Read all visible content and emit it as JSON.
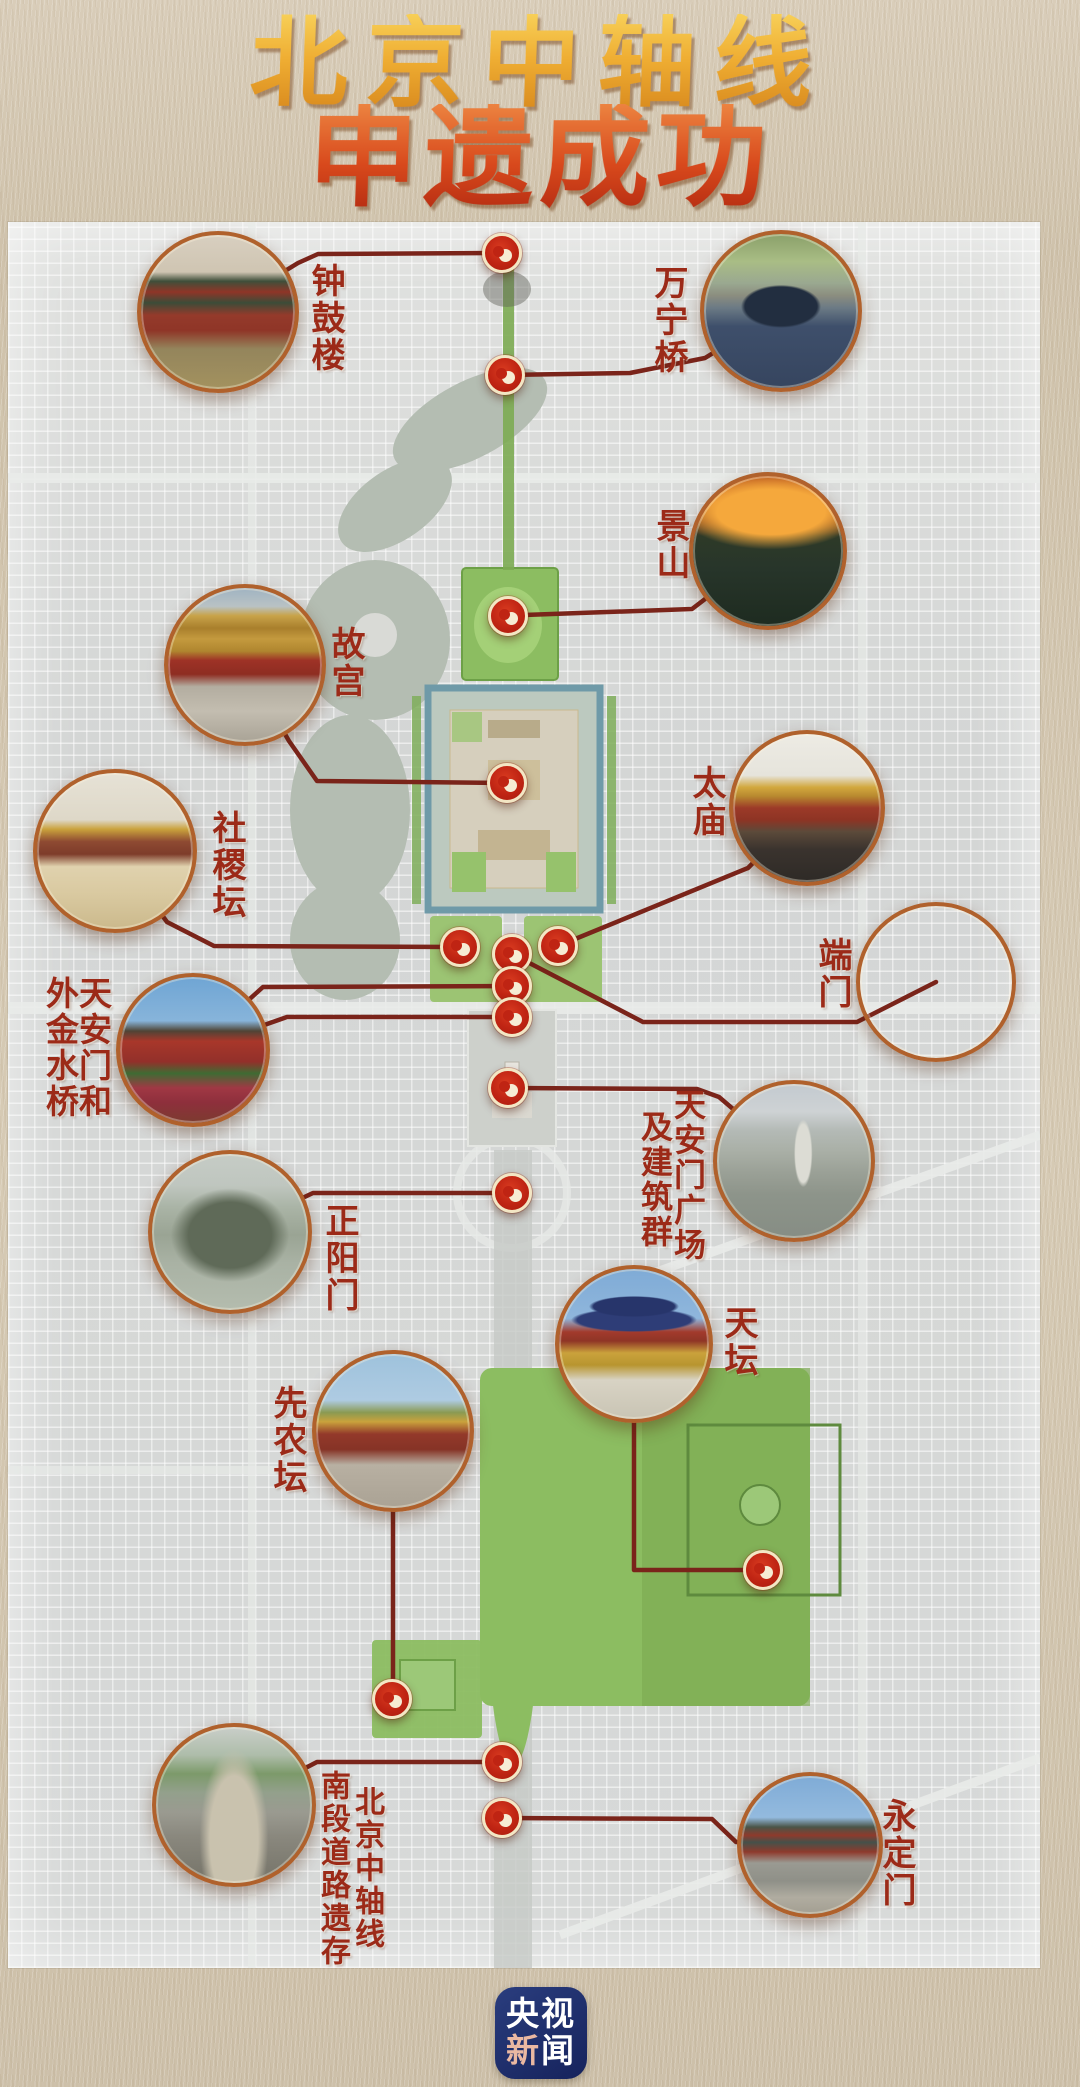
{
  "title": {
    "line1": "北京中轴线",
    "line2": "申遗成功"
  },
  "logo": {
    "c1": "央",
    "c2": "视",
    "c3": "新",
    "c4": "闻"
  },
  "colors": {
    "paper": "#d2c5ae",
    "map_base": "#d6d8d7",
    "park_green": "#8cbd61",
    "water_gray_green": "#b4bdb2",
    "moat_teal": "#6f9aa8",
    "connector_red": "#7a241a",
    "marker_red": "#bf2413",
    "marker_ring_cream": "#f3e6c4",
    "label_dark_red": "#9c2a18",
    "title_gold": "#efae33",
    "title_red_orange": "#d8491c",
    "logo_navy": "#1c2a66"
  },
  "landmarks": [
    {
      "id": "zhonggulou",
      "name": "钟鼓楼",
      "label_cols": [
        {
          "text": "钟鼓楼",
          "x": 327,
          "y": 263,
          "size": 34
        }
      ],
      "circle": {
        "x": 218,
        "y": 312,
        "r": 81
      },
      "markers": [
        [
          502,
          253
        ]
      ],
      "lines": [
        [
          [
            218,
            312
          ],
          [
            298,
            263
          ],
          [
            318,
            254
          ],
          [
            502,
            253
          ]
        ]
      ]
    },
    {
      "id": "wanningqiao",
      "name": "万宁桥",
      "label_cols": [
        {
          "text": "万宁桥",
          "x": 670,
          "y": 265,
          "size": 34
        }
      ],
      "circle": {
        "x": 781,
        "y": 311,
        "r": 81
      },
      "markers": [
        [
          505,
          375
        ]
      ],
      "lines": [
        [
          [
            781,
            311
          ],
          [
            705,
            358
          ],
          [
            630,
            373
          ],
          [
            505,
            375
          ]
        ]
      ]
    },
    {
      "id": "jingshan",
      "name": "景山",
      "label_cols": [
        {
          "text": "景山",
          "x": 672,
          "y": 508,
          "size": 34
        }
      ],
      "circle": {
        "x": 768,
        "y": 551,
        "r": 79
      },
      "markers": [
        [
          508,
          616
        ]
      ],
      "lines": [
        [
          [
            768,
            551
          ],
          [
            692,
            609
          ],
          [
            524,
            615
          ],
          [
            508,
            616
          ]
        ]
      ]
    },
    {
      "id": "gugong",
      "name": "故宫",
      "label_cols": [
        {
          "text": "故宫",
          "x": 347,
          "y": 626,
          "size": 34
        }
      ],
      "circle": {
        "x": 245,
        "y": 665,
        "r": 81
      },
      "markers": [
        [
          507,
          783
        ]
      ],
      "lines": [
        [
          [
            245,
            665
          ],
          [
            289,
            741
          ],
          [
            317,
            781
          ],
          [
            507,
            783
          ]
        ]
      ]
    },
    {
      "id": "shejitan",
      "name": "社稷坛",
      "label_cols": [
        {
          "text": "社稷坛",
          "x": 228,
          "y": 810,
          "size": 34
        }
      ],
      "circle": {
        "x": 115,
        "y": 851,
        "r": 82
      },
      "markers": [
        [
          460,
          947
        ]
      ],
      "lines": [
        [
          [
            115,
            851
          ],
          [
            167,
            922
          ],
          [
            214,
            946
          ],
          [
            460,
            947
          ]
        ]
      ]
    },
    {
      "id": "taimiao",
      "name": "太庙",
      "label_cols": [
        {
          "text": "太庙",
          "x": 708,
          "y": 765,
          "size": 34
        }
      ],
      "circle": {
        "x": 807,
        "y": 808,
        "r": 78
      },
      "markers": [
        [
          558,
          946
        ]
      ],
      "lines": [
        [
          [
            807,
            808
          ],
          [
            748,
            868
          ],
          [
            558,
            946
          ]
        ]
      ]
    },
    {
      "id": "duanmen",
      "name": "端门",
      "label_cols": [
        {
          "text": "端门",
          "x": 834,
          "y": 937,
          "size": 34
        }
      ],
      "circle": {
        "x": 936,
        "y": 982,
        "r": 80
      },
      "markers": [
        [
          512,
          954
        ]
      ],
      "lines": [
        [
          [
            936,
            982
          ],
          [
            857,
            1022
          ],
          [
            643,
            1022
          ],
          [
            512,
            954
          ]
        ]
      ]
    },
    {
      "id": "tiananmen",
      "name": "天安门和外金水桥",
      "label_cols": [
        {
          "text": "天安门和",
          "x": 95,
          "y": 976,
          "size": 33
        },
        {
          "text": "外金水桥",
          "x": 62,
          "y": 976,
          "size": 33
        }
      ],
      "circle": {
        "x": 193,
        "y": 1050,
        "r": 77
      },
      "markers": [
        [
          512,
          986
        ],
        [
          512,
          1017
        ]
      ],
      "lines": [
        [
          [
            193,
            1050
          ],
          [
            263,
            987
          ],
          [
            512,
            986
          ]
        ],
        [
          [
            193,
            1050
          ],
          [
            287,
            1017
          ],
          [
            512,
            1017
          ]
        ]
      ]
    },
    {
      "id": "guangchang",
      "name": "天安门广场及建筑群",
      "label_cols": [
        {
          "text": "天安门广场",
          "x": 690,
          "y": 1088,
          "size": 32
        },
        {
          "text": "及建筑群",
          "x": 657,
          "y": 1110,
          "size": 32
        }
      ],
      "circle": {
        "x": 794,
        "y": 1161,
        "r": 81
      },
      "markers": [
        [
          508,
          1088
        ]
      ],
      "lines": [
        [
          [
            794,
            1161
          ],
          [
            719,
            1097
          ],
          [
            697,
            1089
          ],
          [
            508,
            1088
          ]
        ]
      ]
    },
    {
      "id": "zhengyangmen",
      "name": "正阳门",
      "label_cols": [
        {
          "text": "正阳门",
          "x": 341,
          "y": 1203,
          "size": 34
        }
      ],
      "circle": {
        "x": 230,
        "y": 1232,
        "r": 82
      },
      "markers": [
        [
          512,
          1193
        ]
      ],
      "lines": [
        [
          [
            230,
            1232
          ],
          [
            313,
            1193
          ],
          [
            512,
            1193
          ]
        ]
      ]
    },
    {
      "id": "tiantan",
      "name": "天坛",
      "label_cols": [
        {
          "text": "天坛",
          "x": 740,
          "y": 1305,
          "size": 34
        }
      ],
      "circle": {
        "x": 634,
        "y": 1344,
        "r": 79
      },
      "markers": [
        [
          763,
          1570
        ]
      ],
      "lines": [
        [
          [
            634,
            1344
          ],
          [
            634,
            1570
          ],
          [
            763,
            1570
          ]
        ]
      ]
    },
    {
      "id": "xiannongtan",
      "name": "先农坛",
      "label_cols": [
        {
          "text": "先农坛",
          "x": 289,
          "y": 1385,
          "size": 34
        }
      ],
      "circle": {
        "x": 393,
        "y": 1431,
        "r": 81
      },
      "markers": [
        [
          392,
          1699
        ]
      ],
      "lines": [
        [
          [
            393,
            1431
          ],
          [
            393,
            1699
          ]
        ]
      ]
    },
    {
      "id": "nanduan",
      "name": "北京中轴线南段道路遗存",
      "label_cols": [
        {
          "text": "北京中轴线",
          "x": 368,
          "y": 1786,
          "size": 30
        },
        {
          "text": "南段道路遗存",
          "x": 334,
          "y": 1770,
          "size": 30
        }
      ],
      "circle": {
        "x": 234,
        "y": 1805,
        "r": 82
      },
      "markers": [
        [
          502,
          1762
        ]
      ],
      "lines": [
        [
          [
            234,
            1805
          ],
          [
            317,
            1762
          ],
          [
            502,
            1762
          ]
        ]
      ]
    },
    {
      "id": "yongdingmen",
      "name": "永定门",
      "label_cols": [
        {
          "text": "永定门",
          "x": 898,
          "y": 1798,
          "size": 34
        }
      ],
      "circle": {
        "x": 810,
        "y": 1845,
        "r": 73
      },
      "markers": [
        [
          502,
          1818
        ]
      ],
      "lines": [
        [
          [
            810,
            1845
          ],
          [
            736,
            1842
          ],
          [
            712,
            1819
          ],
          [
            502,
            1818
          ]
        ]
      ]
    }
  ]
}
